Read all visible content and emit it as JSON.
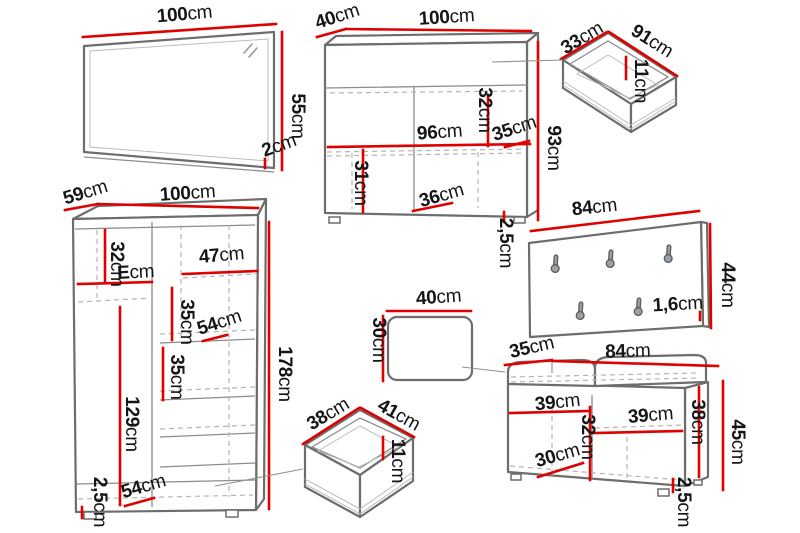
{
  "unit": "cm",
  "colors": {
    "dimension-red": "#e00000",
    "outline-gray": "#6d6d6d",
    "dash-gray": "#b5b5b5",
    "label-black": "#151515"
  },
  "items": {
    "mirror": {
      "width": {
        "n": "100",
        "u": "cm"
      },
      "height": {
        "n": "55",
        "u": "cm"
      },
      "depth": {
        "n": "2",
        "u": "cm"
      }
    },
    "chest": {
      "depth": {
        "n": "40",
        "u": "cm"
      },
      "width": {
        "n": "100",
        "u": "cm"
      },
      "top_section_height": {
        "n": "32",
        "u": "cm"
      },
      "inner_width": {
        "n": "96",
        "u": "cm"
      },
      "shelf_depth": {
        "n": "35",
        "u": "cm"
      },
      "height": {
        "n": "93",
        "u": "cm"
      },
      "lower_section_height": {
        "n": "31",
        "u": "cm"
      },
      "compartment_width": {
        "n": "36",
        "u": "cm"
      },
      "plinth_height": {
        "n": "2,5",
        "u": "cm"
      }
    },
    "drawer_top": {
      "depth": {
        "n": "33",
        "u": "cm"
      },
      "width": {
        "n": "91",
        "u": "cm"
      },
      "inner_height": {
        "n": "11",
        "u": "cm"
      }
    },
    "coat_panel": {
      "width": {
        "n": "84",
        "u": "cm"
      },
      "height": {
        "n": "44",
        "u": "cm"
      },
      "thickness": {
        "n": "1,6",
        "u": "cm"
      },
      "hook_count": 5
    },
    "wardrobe": {
      "depth": {
        "n": "59",
        "u": "cm"
      },
      "width": {
        "n": "100",
        "u": "cm"
      },
      "top_shelf_height": {
        "n": "32",
        "u": "cm"
      },
      "left_compartment_width": {
        "n": "E",
        "u": "cm"
      },
      "right_compartment_width": {
        "n": "47",
        "u": "cm"
      },
      "upper_shelf_gap": {
        "n": "35",
        "u": "cm"
      },
      "shelf_depth": {
        "n": "54",
        "u": "cm"
      },
      "lower_shelf_gap": {
        "n": "35",
        "u": "cm"
      },
      "height": {
        "n": "178",
        "u": "cm"
      },
      "hanging_height": {
        "n": "129",
        "u": "cm"
      },
      "plinth_height": {
        "n": "2,5",
        "u": "cm"
      },
      "bottom_shelf_depth": {
        "n": "54",
        "u": "cm"
      }
    },
    "cushion": {
      "width": {
        "n": "40",
        "u": "cm"
      },
      "depth": {
        "n": "30",
        "u": "cm"
      }
    },
    "drawer_bottom": {
      "depth": {
        "n": "38",
        "u": "cm"
      },
      "width": {
        "n": "41",
        "u": "cm"
      },
      "inner_height": {
        "n": "11",
        "u": "cm"
      }
    },
    "bench": {
      "depth": {
        "n": "35",
        "u": "cm"
      },
      "width": {
        "n": "84",
        "u": "cm"
      },
      "left_compartment_width": {
        "n": "39",
        "u": "cm"
      },
      "right_compartment_width": {
        "n": "39",
        "u": "cm"
      },
      "inner_height": {
        "n": "38",
        "u": "cm"
      },
      "compartment_height": {
        "n": "32",
        "u": "cm"
      },
      "compartment_depth": {
        "n": "30",
        "u": "cm"
      },
      "height": {
        "n": "45",
        "u": "cm"
      },
      "plinth_height": {
        "n": "2,5",
        "u": "cm"
      }
    }
  }
}
